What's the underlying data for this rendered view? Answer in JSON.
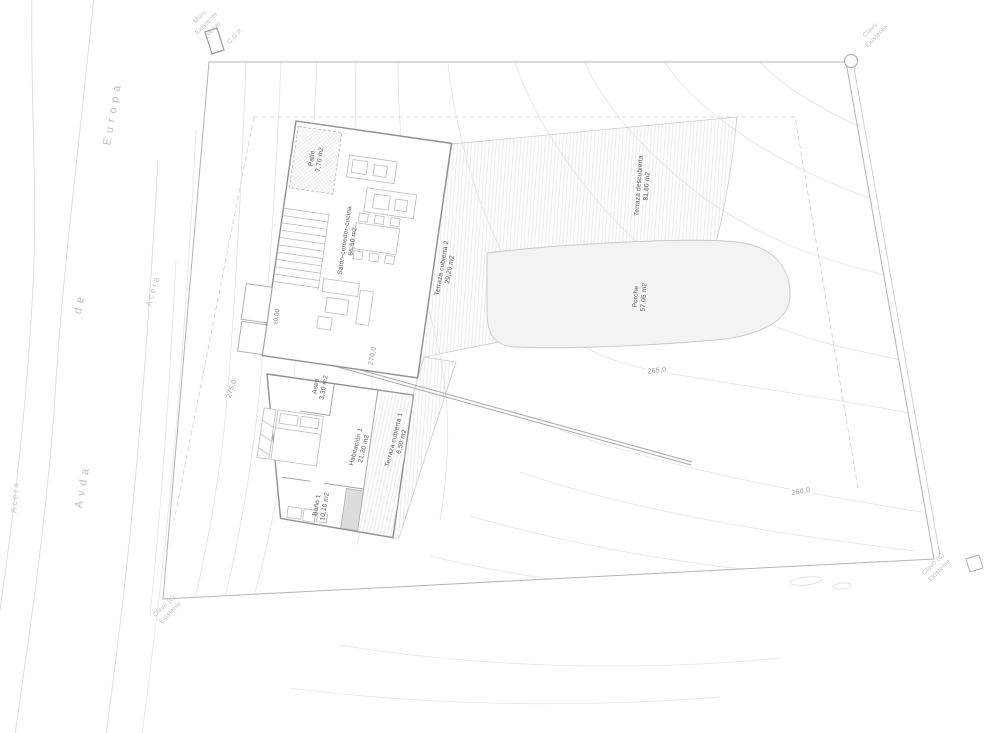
{
  "meta": {
    "drawing_type": "architectural site plan / planta de situación",
    "background": "#ffffff"
  },
  "streets": {
    "avenue_word1": "Avda",
    "avenue_word2": "de",
    "avenue_word3": "Europa",
    "sidewalk_outer": "Acera",
    "sidewalk_inner": "Acera"
  },
  "site": {
    "annotations": {
      "top_left_wall": {
        "lines": [
          "Muro",
          "Existente",
          "(verja)"
        ]
      },
      "top_left_cgp": "C.G.P.",
      "top_right": {
        "lines": [
          "Clavo",
          "Existente"
        ]
      },
      "bottom_left": {
        "lines": [
          "Clavo (o)",
          "Existente"
        ]
      },
      "bottom_right": {
        "lines": [
          "Clavo (o)",
          "Existente"
        ]
      }
    },
    "contour_labels": [
      {
        "value": "275,0"
      },
      {
        "value": "270,0"
      },
      {
        "value": "265,0"
      },
      {
        "value": "260,0"
      }
    ]
  },
  "plan": {
    "level_marker": "±0,00",
    "rooms": [
      {
        "name": "Patio",
        "area": "7,70 m2"
      },
      {
        "name": "Salón-comedor-cocina",
        "area": "66,50 m2"
      },
      {
        "name": "Terraza cubierta 2",
        "area": "29,20 m2"
      },
      {
        "name": "Terraza descubierta",
        "area": "81,80 m2"
      },
      {
        "name": "Porche",
        "area": "57,05 m2"
      },
      {
        "name": "Aseo",
        "area": "3,30 m2"
      },
      {
        "name": "Habitación 1",
        "area": "21,20 m2"
      },
      {
        "name": "Terraza cubierta 1",
        "area": "6,50 m2"
      },
      {
        "name": "Baño 1",
        "area": "10,10 m2"
      }
    ]
  },
  "colors": {
    "line_faint": "#e3e3e3",
    "line_light": "#cfcfcf",
    "line_mid": "#b0b0b0",
    "wall": "#8f8f8f",
    "room_text": "#555555",
    "street_text": "#bdbdbd",
    "contour_text": "#9a9a9a",
    "porch_fill": "#f3f3f3",
    "shower_fill": "#dcdcdc"
  }
}
